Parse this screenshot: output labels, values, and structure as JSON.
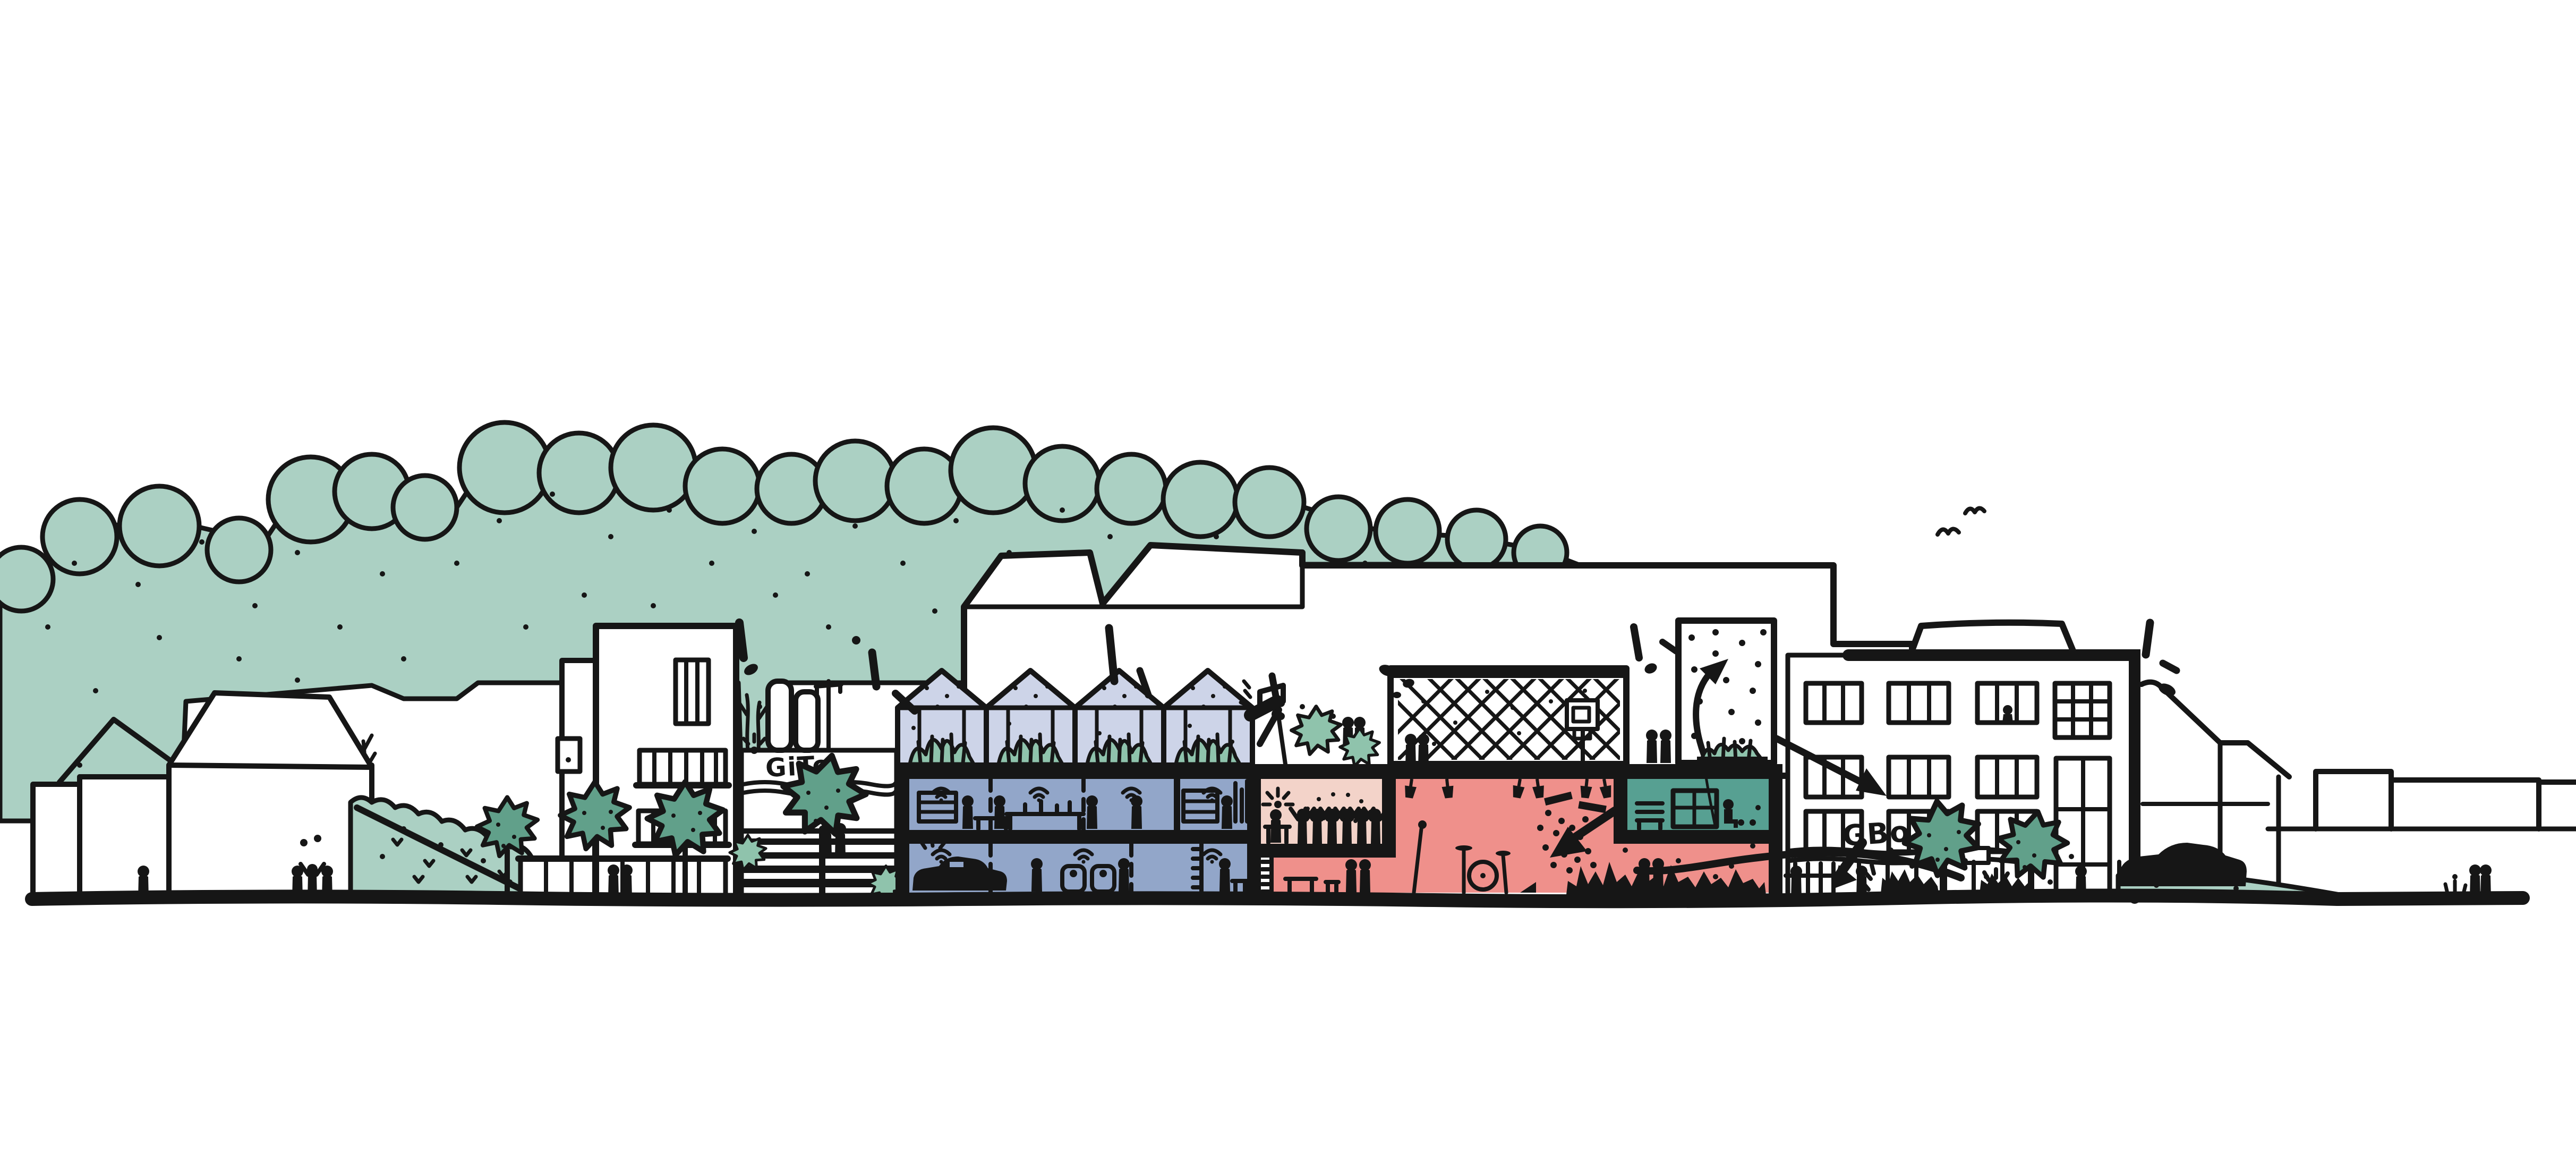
{
  "illustration": {
    "kind": "hand-drawn urban street elevation and building section sketch",
    "labels": {
      "left_building_sign": "GiTo",
      "right_building_sign": "GBo"
    },
    "colors": {
      "paper": "#ffffff",
      "ink": "#161616",
      "foliage_light": "#abd0c3",
      "foliage_mid": "#8fc3ac",
      "foliage_dark": "#61a08a",
      "greenhouse_glass": "#cdd4e8",
      "residential_blue": "#92a6c9",
      "classroom_pink": "#f3d3c9",
      "hall_salmon": "#ef908b",
      "lounge_teal": "#57a092"
    },
    "features": [
      "background tree line with dots",
      "large background warehouse with roof monitors",
      "pitched-roof houses on the left",
      "apartment slab with window bands",
      "GiTo block with sparkle, wavy underline and stairs",
      "rooftop greenhouses with planted beds",
      "two blue residential floors with car garage, furniture and people",
      "light pink classroom with audience raising arms",
      "salmon concert hall with stage lights, disco dots, drums and crowd",
      "rooftop sports cage with basketball hoop",
      "dotted climbing tower with up arrow",
      "teal lounge room with bench and shelf",
      "GBo building with window grid, colonnade and crowd",
      "street trees and hedge slope",
      "black car on green mound",
      "flying birds and sparkle accents",
      "flow arrows between hall, tower and GBo building"
    ]
  }
}
